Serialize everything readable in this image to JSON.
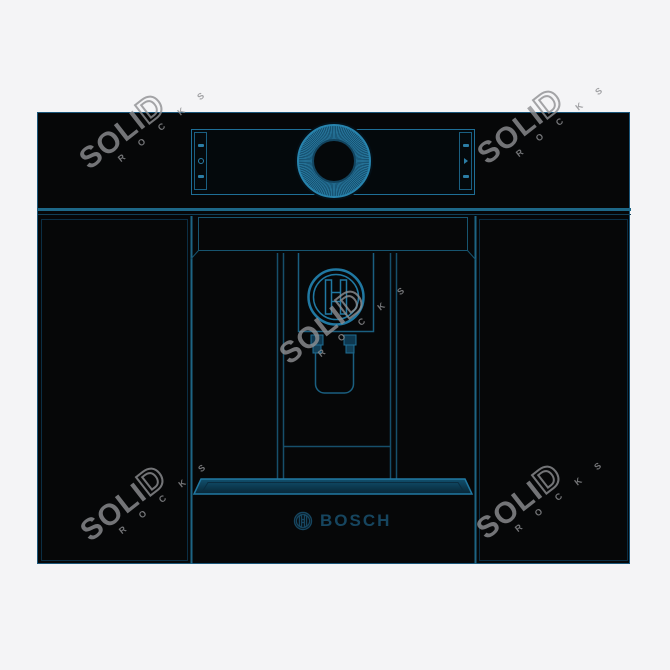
{
  "image_title": "Bosch built-in coffee machine wireframe render",
  "colors": {
    "background": "#f4f4f6",
    "body_black": "#060708",
    "outline_teal": "#1d6080",
    "accent_teal": "#2078a2",
    "brand_dark_teal": "#16455f",
    "watermark_gray": "#8f9093"
  },
  "watermark": {
    "word_solid_part": "SOLI",
    "word_outline_part": "D",
    "word2": "R O C K S"
  },
  "machine": {
    "brand": "BOSCH",
    "control_panel": {
      "left_buttons": [
        {
          "icon": "cup-small-icon"
        },
        {
          "icon": "dial-icon"
        },
        {
          "icon": "cup-large-icon"
        }
      ],
      "right_buttons": [
        {
          "icon": "strength-icon"
        },
        {
          "icon": "start-icon"
        },
        {
          "icon": "volume-icon"
        }
      ],
      "knob": {
        "icon": "rotary-knob"
      }
    },
    "dispenser": {
      "logo": "bosch-symbol"
    },
    "drawer": {
      "brand": "BOSCH"
    }
  }
}
